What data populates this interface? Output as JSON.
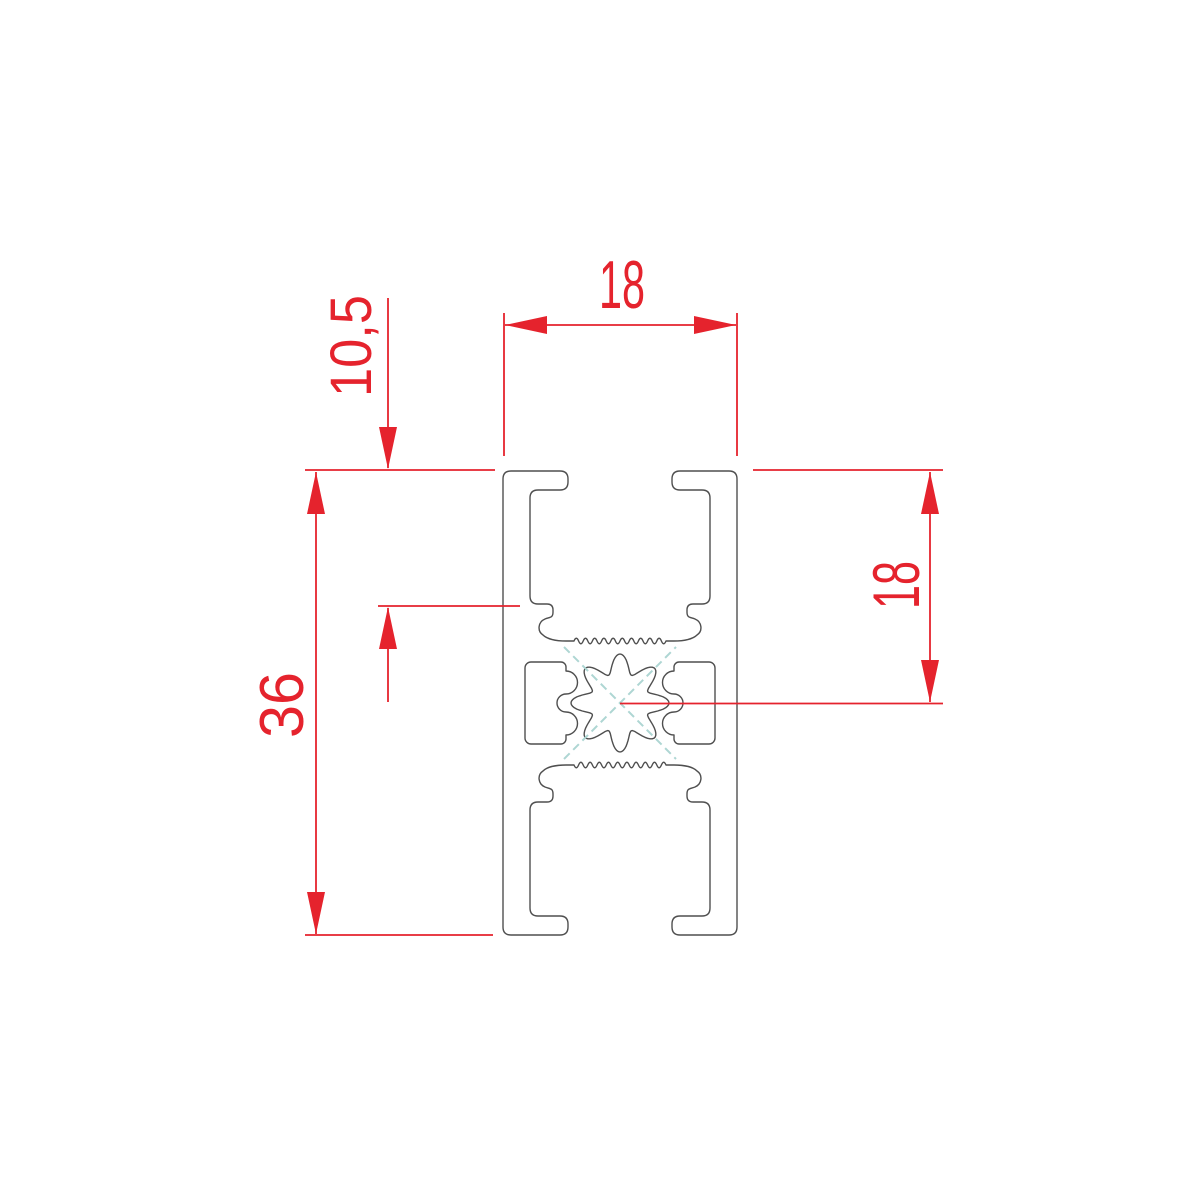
{
  "drawing": {
    "type": "technical-cross-section",
    "labels": {
      "width_top": "18",
      "slot_depth": "10,5",
      "overall_height": "36",
      "center_height": "18"
    },
    "colors": {
      "dimension_red": "#e5232d",
      "profile_outline": "#4f4f4f",
      "centerline_teal": "#aed6d3"
    }
  }
}
